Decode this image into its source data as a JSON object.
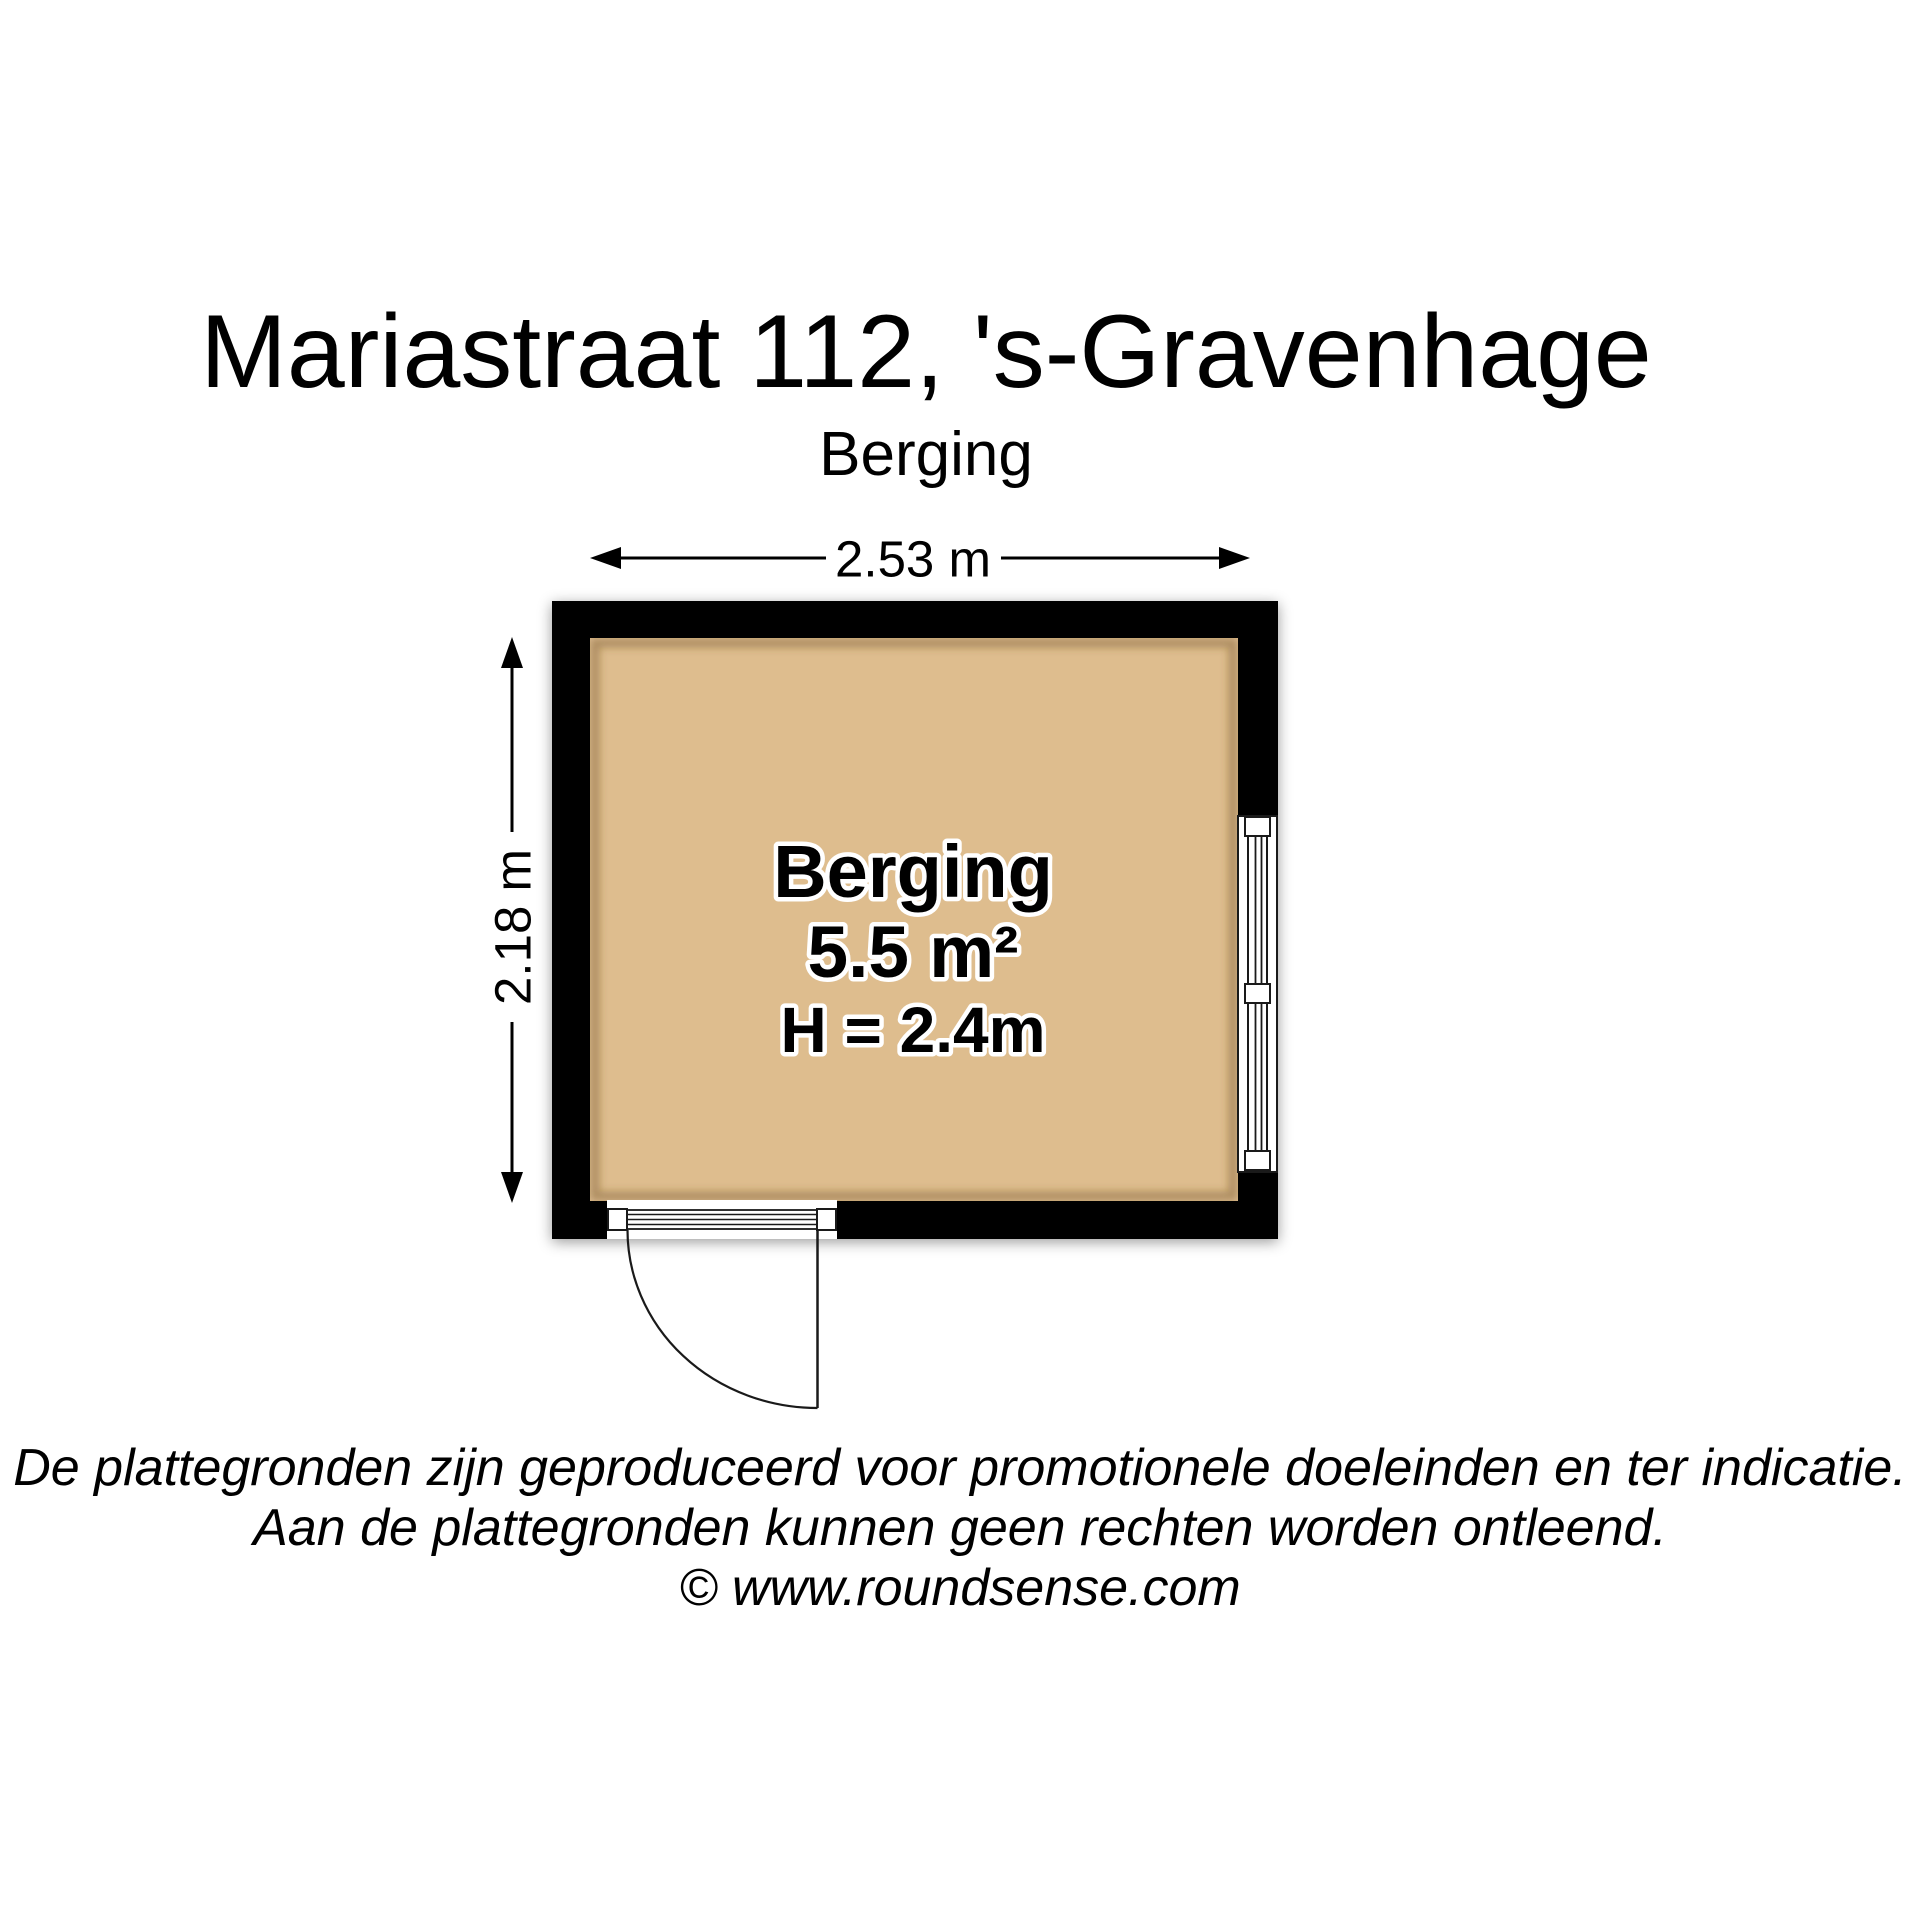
{
  "title": "Mariastraat 112, 's-Gravenhage",
  "subtitle": "Berging",
  "floorplan": {
    "room": {
      "name": "Berging",
      "area": "5.5 m²",
      "ceiling_height": "H = 2.4m"
    },
    "dimensions": {
      "width_label": "2.53 m",
      "height_label": "2.18 m"
    },
    "features": {
      "window": "window-right-wall",
      "door": "door-bottom-left-outward-swing"
    },
    "colors": {
      "wall": "#000000",
      "floor": "#DEBD8E",
      "line": "#1a1a1a",
      "background": "#ffffff"
    }
  },
  "footer": {
    "line1": "De plattegronden zijn geproduceerd voor promotionele doeleinden en ter indicatie.",
    "line2": "Aan de plattegronden kunnen geen rechten worden ontleend.",
    "line3": "© www.roundsense.com"
  }
}
